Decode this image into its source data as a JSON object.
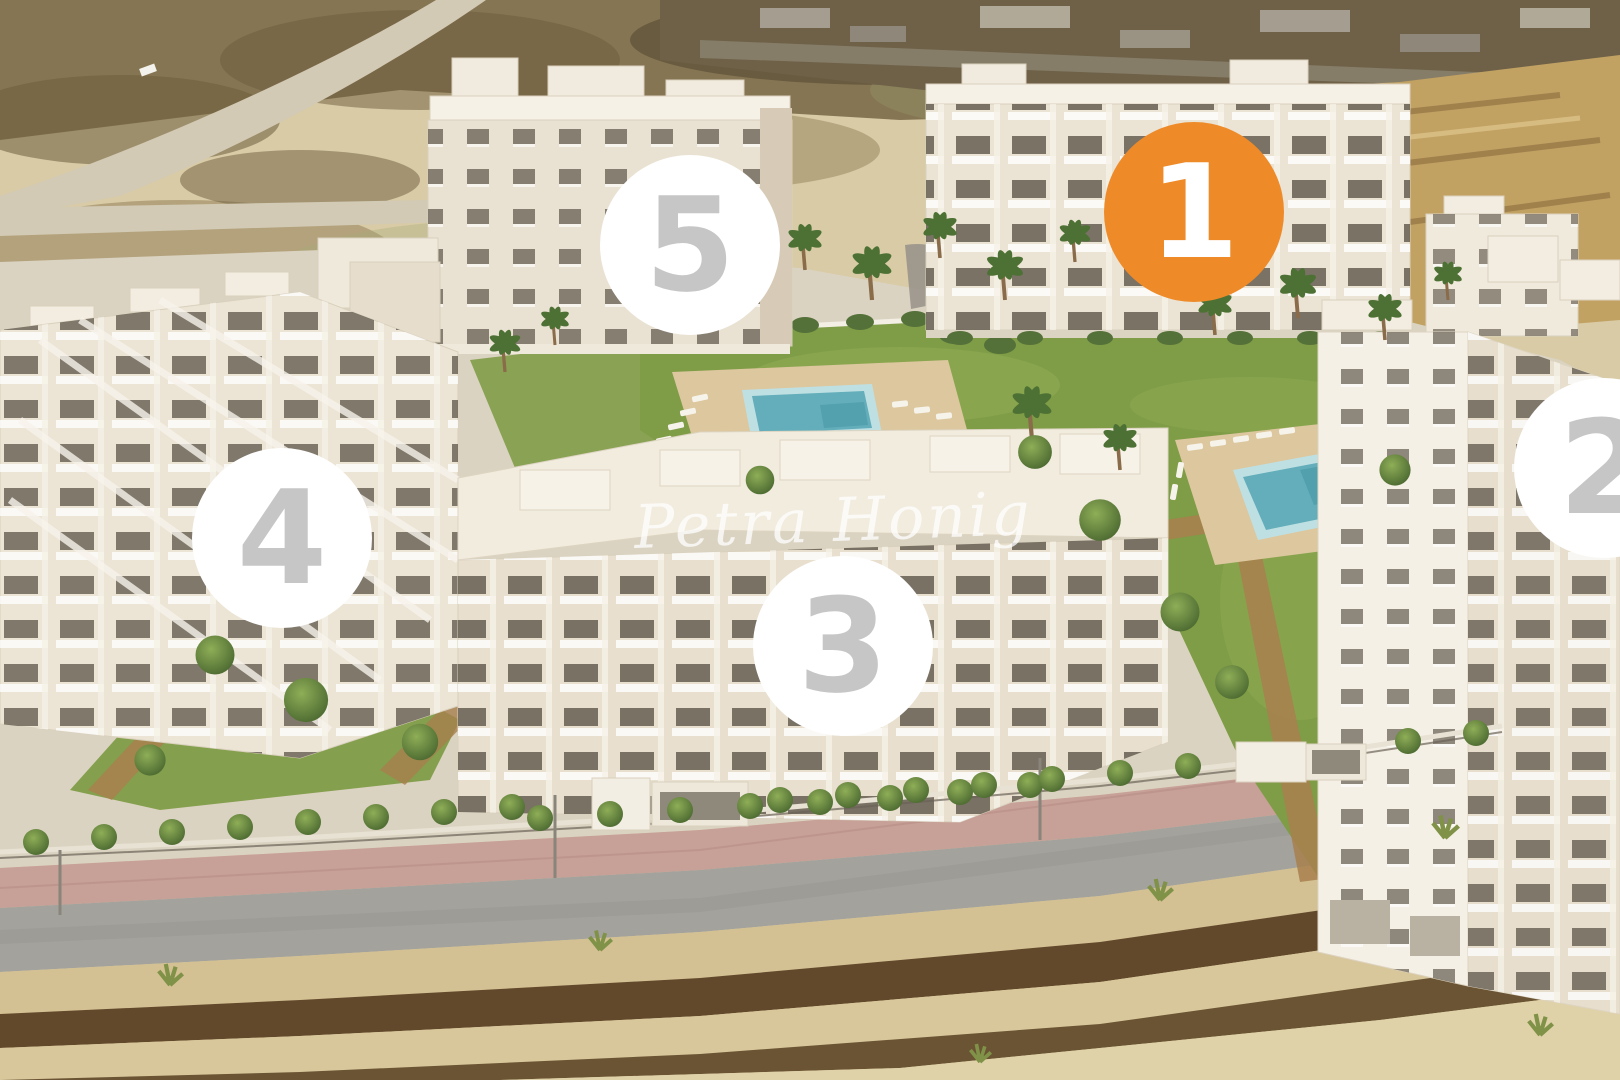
{
  "scene": {
    "watermark": "Petra Honig"
  },
  "markers": [
    {
      "label": "1",
      "highlighted": true
    },
    {
      "label": "2",
      "highlighted": false
    },
    {
      "label": "3",
      "highlighted": false
    },
    {
      "label": "4",
      "highlighted": false
    },
    {
      "label": "5",
      "highlighted": false
    }
  ],
  "colors": {
    "marker_highlight_bg": "#EE8A28",
    "marker_highlight_text": "#FFFFFF",
    "marker_bg": "#FFFFFF",
    "marker_text": "#C6C6C6",
    "pool_water": "#63AEBA",
    "lawn_green": "#7F9C47",
    "building_wall": "#EFE9DC",
    "terrain_sand": "#D8CBA6",
    "terrain_dark_soil": "#6B5433",
    "road_asphalt": "#A3A29D",
    "sidewalk_pink": "#C7A097"
  }
}
